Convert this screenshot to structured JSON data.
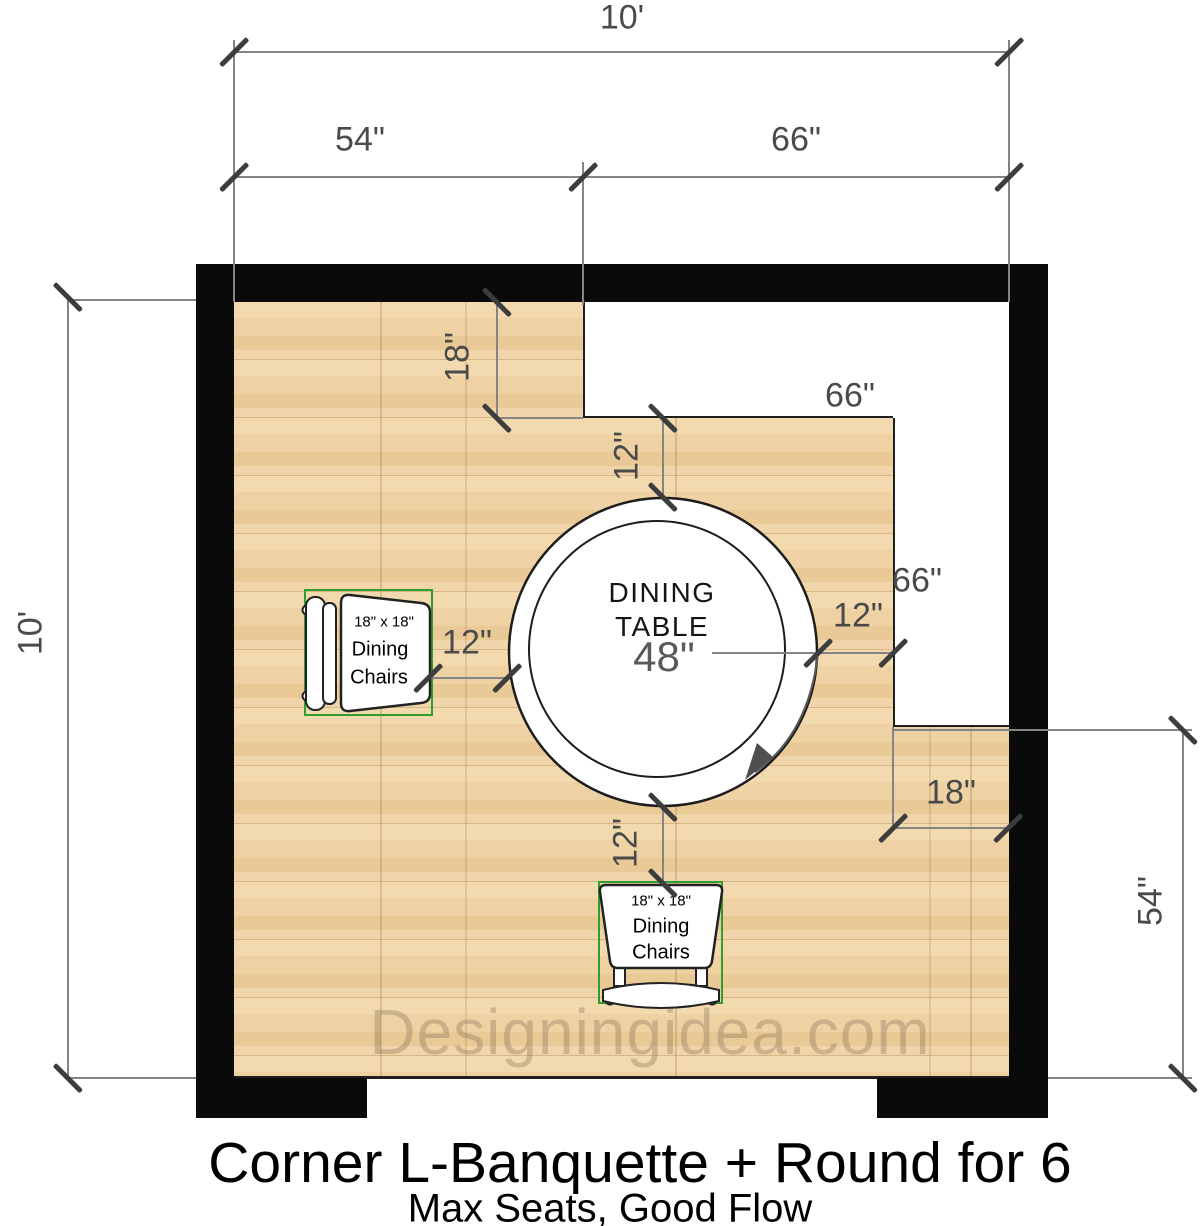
{
  "title": {
    "main": "Corner L-Banquette + Round for 6",
    "subtitle": "Max Seats, Good Flow"
  },
  "watermark": "Designingidea.com",
  "dims": {
    "top_overall": "10'",
    "left_overall": "10'",
    "top_left_segment": "54\"",
    "top_right_segment": "66\"",
    "right_lower_segment": "54\"",
    "banquette_top_length": "66\"",
    "banquette_right_length": "66\"",
    "banquette_top_depth": "18\"",
    "banquette_right_depth": "18\"",
    "clearance_banquette_top": "12\"",
    "clearance_banquette_right": "12\"",
    "clearance_chair_left": "12\"",
    "clearance_chair_bottom": "12\""
  },
  "table": {
    "line1": "DINING",
    "line2": "TABLE",
    "diameter": "48\""
  },
  "chair": {
    "size": "18\" x 18\"",
    "type_line1": "Dining",
    "type_line2": "Chairs"
  },
  "colors": {
    "wall": "#0a0a0a",
    "wood": "#eccfa0",
    "banquette": "#ffffff",
    "dimension_text": "#4a4a4a",
    "chair_bounding_green": "#2f9e2f"
  }
}
